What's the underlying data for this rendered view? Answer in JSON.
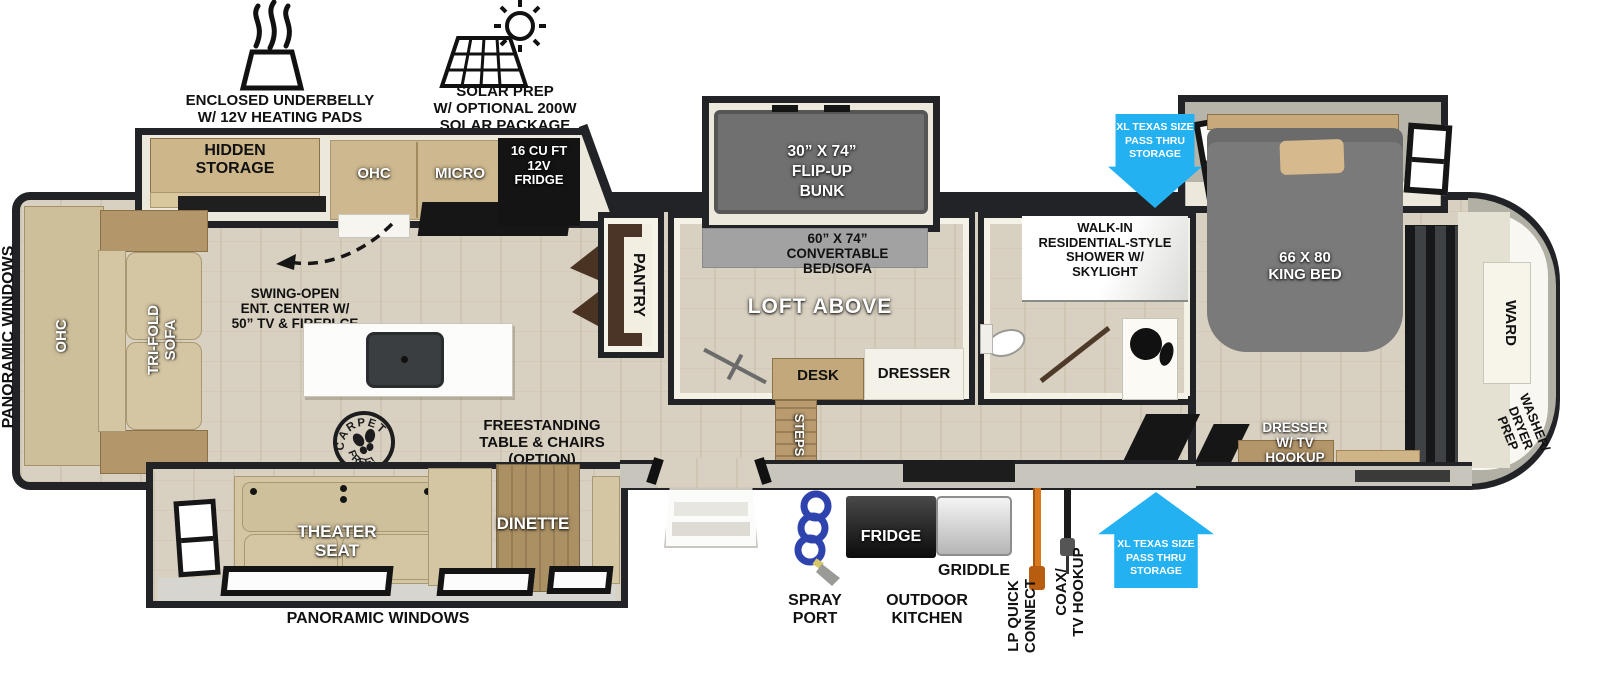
{
  "badges": {
    "underbelly": [
      "ENCLOSED UNDERBELLY",
      "W/ 12V HEATING PADS"
    ],
    "solar": [
      "SOLAR PREP",
      "W/ OPTIONAL 200W",
      "SOLAR PACKAGE"
    ]
  },
  "arrow": [
    "XL TEXAS SIZE",
    "PASS THRU",
    "STORAGE"
  ],
  "exterior": {
    "panoramic_left": "PANORAMIC WINDOWS",
    "panoramic_bottom": "PANORAMIC WINDOWS"
  },
  "living": {
    "ohc_rear": "OHC",
    "trifold": [
      "TRI-FOLD",
      "SOFA"
    ],
    "hidden": [
      "HIDDEN",
      "STORAGE"
    ],
    "ohc": "OHC",
    "micro": "MICRO",
    "fridge": [
      "16 CU FT",
      "12V",
      "FRIDGE"
    ],
    "swing": [
      "SWING-OPEN",
      "ENT. CENTER W/",
      "50” TV & FIREPLCE"
    ],
    "stamp": [
      "CARPET",
      "FREE!"
    ],
    "freestanding": [
      "FREESTANDING",
      "TABLE & CHAIRS",
      "(OPTION)"
    ],
    "theater": [
      "THEATER",
      "SEAT"
    ],
    "dinette": "DINETTE",
    "pantry": "PANTRY",
    "steps": "STEPS"
  },
  "loft": {
    "bunk": [
      "30” X 74”",
      "FLIP-UP",
      "BUNK"
    ],
    "convertible": [
      "60” X 74”",
      "CONVERTABLE",
      "BED/SOFA"
    ],
    "loft_above": "LOFT ABOVE",
    "desk": "DESK",
    "dresser": "DRESSER"
  },
  "bath": {
    "shower": [
      "WALK-IN",
      "RESIDENTIAL-STYLE",
      "SHOWER W/",
      "SKYLIGHT"
    ]
  },
  "bedroom": {
    "king": [
      "66 X 80",
      "KING BED"
    ],
    "ward": "WARD",
    "washer": [
      "WASHER/",
      "DRYER",
      "PREP"
    ],
    "dresser_tv": [
      "DRESSER",
      "W/ TV",
      "HOOKUP"
    ]
  },
  "outdoor": {
    "spray": [
      "SPRAY",
      "PORT"
    ],
    "fridge": "FRIDGE",
    "griddle": "GRIDDLE",
    "kitchen": [
      "OUTDOOR",
      "KITCHEN"
    ],
    "lp": [
      "LP QUICK",
      "CONNECT"
    ],
    "coax": [
      "COAX/",
      "TV HOOKUP"
    ]
  },
  "colors": {
    "arrow_blue": "#24b1f2",
    "wall_black": "#212326",
    "floor_wood": "#d8d0c0",
    "bed_gray": "#7a7a7a",
    "sofa_tan": "#d5c6a3"
  }
}
